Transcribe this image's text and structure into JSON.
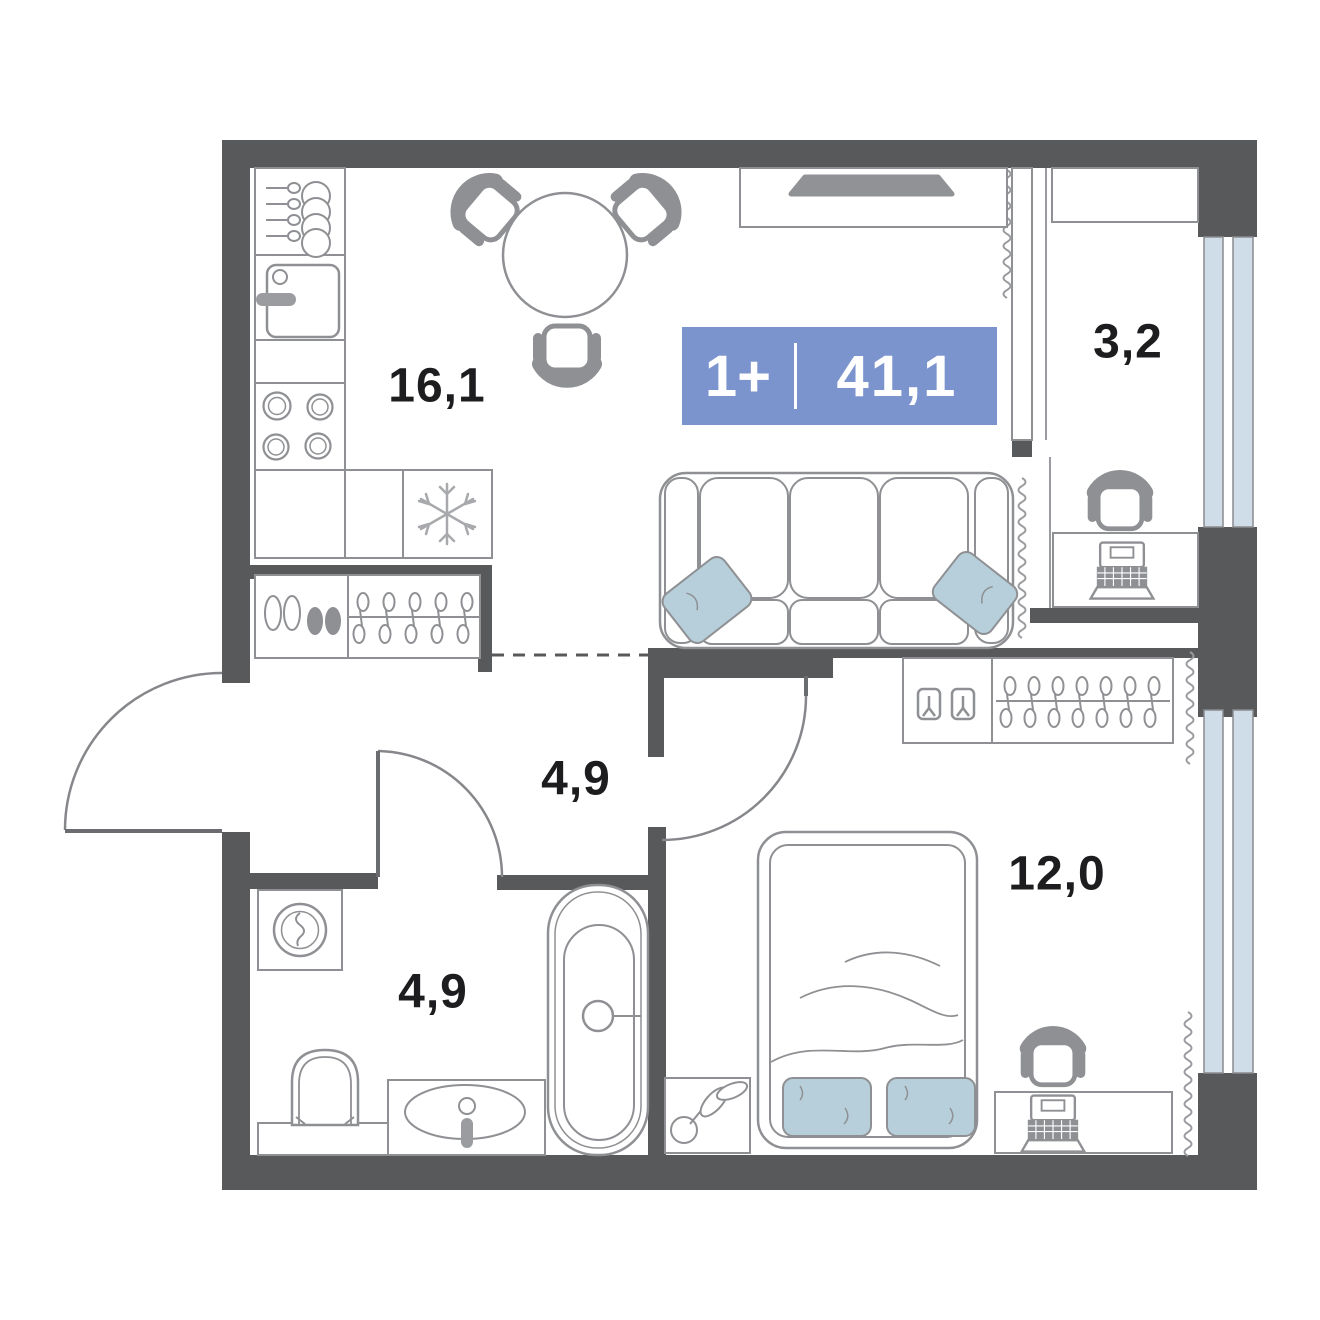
{
  "page": {
    "background": "#ffffff",
    "type_label": "apartment floor plan"
  },
  "badge": {
    "rooms_label": "1+",
    "total_area": "41,1",
    "color": "#7b94ce"
  },
  "rooms": [
    {
      "id": "kitchen-living-room",
      "area_label": "16,1"
    },
    {
      "id": "loggia",
      "area_label": "3,2"
    },
    {
      "id": "hallway",
      "area_label": "4,9"
    },
    {
      "id": "bathroom",
      "area_label": "4,9"
    },
    {
      "id": "bedroom",
      "area_label": "12,0"
    }
  ],
  "colors": {
    "wall": "#58595b",
    "furniture_line": "#8e9093",
    "chair_fill": "#8e9093",
    "textile": "#b7cfda",
    "window_glass": "#cfdde8",
    "label_text": "#1d1d1f",
    "badge_blue": "#7b94ce"
  }
}
